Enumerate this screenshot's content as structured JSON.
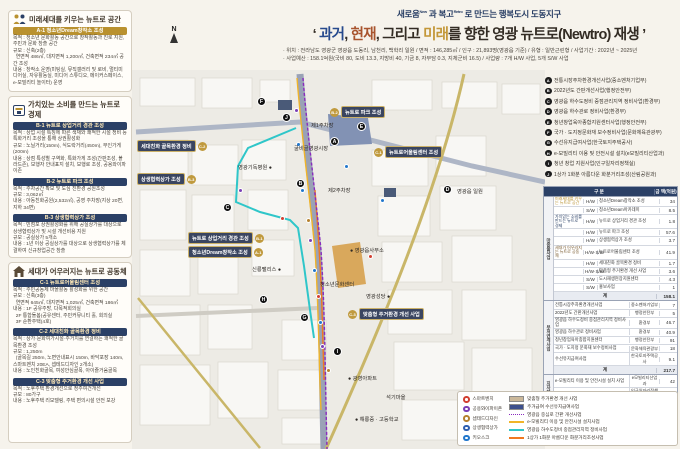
{
  "header": {
    "sub_s1": "새로움",
    "sub_sup1": "New",
    "sub_s2": " 과 복고",
    "sub_sup2": "Retro",
    "sub_s3": " 로 만드는 행복도시 도동지구",
    "title_q1": "‘ ",
    "title_past": "과거",
    "title_t1": ", ",
    "title_now": "현재",
    "title_t2": ", 그리고 ",
    "title_future": "미래",
    "title_rest": "를 향한 영광 뉴트로(Newtro) 재생",
    "title_q2": " ’",
    "info_line1": "· 위치 : 전라남도 영광군 영광읍 도동리, 남천리, 백학리 일원 / 면적 : 146,285㎡ / 인구 : 21,893명(영광읍 기준) / 유형 : 일반근린형 / 사업기간 : 2022년 ~ 2025년",
    "info_line2": "· 사업예산 : 158.1억원(국비 80, 도비 13.3, 지방비 40, 기금 8, 자부담 0.3, 지체군비 16.5) / 사업량 : 7개 H/W 사업, 5개 S/W 사업"
  },
  "sidebar": {
    "sections": [
      {
        "title": "미래세대를 키우는 뉴트로 공간",
        "projects": [
          {
            "bar": "A-1 청소년Dream창작소 조성",
            "lines": [
              "목적 : 청소년 문화활동 공간으로 창작활동과 진로 지원, 주민과 문화 창출 공간",
              "규모 : 신축(2층)",
              "  연면적 486㎡, 대지면적 1,200㎡, 건축면적 234㎡ 공간 조성",
              "내용 : 창작소 운영(미팅실, 뮤직갤러리 및 로비, 멀티미디어실, 자유활동실, 미디어 스튜디오, 메이커스페이스, e-모빌리티 놀이터) 운영"
            ]
          }
        ]
      },
      {
        "title": "가치있는 소비를 만드는 뉴트로 경제",
        "projects": [
          {
            "bar": "B-1 뉴트로 상업거리 경관 조성",
            "lines": [
              "목적 : 상업 시설 특징에 따른 색채와 쾌적한 시설 정비 등 특화거리 조성을 통해 상권활성화",
              "규모 : 노닐거리(150m), 식도락거리(450m), 무인가게(200m)",
              "내용 : 상점 특성별 구역화, 특화가게 조성(간판조성, 볼라드존), 보행자 안내표지 설치, 보행로 조성, 공용와이파이존"
            ]
          },
          {
            "bar": "B-2 뉴트로 파크 조성",
            "lines": [
              "목적 : 주차공간 확보 및 도심 친환경 공원조성",
              "규모 : 3,062㎡",
              "내용 : 아동친화공원(2,532㎡), 공영 주차장(지상 20면, 지하 34면)"
            ]
          },
          {
            "bar": "B-3 상생협력상가 조성",
            "lines": [
              "목적 : 빈점포 상권활성화를 위해 공실상가를 대상으로 상생협력상가 및 시설 개선비용 지원",
              "규모 : 공실상가 5개소",
              "내용 : 1년 이상 공실상가를 대상으로 상생협력상가를 체결하여 신규창업공간 창출"
            ]
          }
        ]
      },
      {
        "title": "세대가 어우러지는 뉴트로 공동체",
        "projects": [
          {
            "bar": "C-1 뉴트로어울림센터 조성",
            "lines": [
              "목적 : 주민공동체 마을활동 활성화를 위한 공간",
              "규모 : 신축(3층)",
              "  연면적 645㎡, 대지면적 1,025㎡, 건축면적 186㎡",
              "내용 : 1F 공유주방, 다목적회의실",
              "  2F 통합돌봄(공유센터, 주민커뮤니티 홀, 회의실",
              "  3F 순환주택(4호)"
            ]
          },
          {
            "bar": "C-2 세대친화 골목환경 정비",
            "lines": [
              "목적 : 상가·문화여가시설·주거지를 연결하는 쾌적한 골목환경 조성",
              "규모 : 1,250m",
              "  (골목길 250m, 노면안내표시 150m, 바닥포장 140m, 스마트벤치 20EA, 셉테드디자인 2개소)",
              "내용 : 노인친화골목, 여성안심골목, 아이즐거움골목"
            ]
          },
          {
            "bar": "C-3 맞춤형 주거환경 개선 사업",
            "lines": [
              "목적 : 노후주택 환경개선으로 정주여건개선",
              "규모 : 80가구",
              "내용 : 노후주택 리모델링, 주택 편의시설 안전 보강"
            ]
          }
        ]
      }
    ]
  },
  "linked_projects": [
    {
      "letter": "A",
      "label": "전통시장주차환경개선사업(중소벤처기업부)"
    },
    {
      "letter": "B",
      "label": "2022년도 간판개선사업(행정안전부)"
    },
    {
      "letter": "C",
      "label": "영광읍 하수도정비 중점관리지역 정비사업(환경부)"
    },
    {
      "letter": "D",
      "label": "영광읍 하수관로 정비사업(환경부)"
    },
    {
      "letter": "E",
      "label": "청년창업육아종합지원센터사업(행정안전부)"
    },
    {
      "letter": "F",
      "label": "국가 · 도지정문화재 보수정비사업(문화체육관광부)"
    },
    {
      "letter": "G",
      "label": "수선유지급여사업(한국토지주택공사)"
    },
    {
      "letter": "H",
      "label": "e-모빌리티 이용 및 안전시설 설치(e모빌리티산업과)"
    },
    {
      "letter": "I",
      "label": "청년 창업 지원사업(인구일자리정책실)"
    },
    {
      "letter": "J",
      "label": "1상가 1화분 아름다운 화분거리조성(산림공원과)"
    }
  ],
  "budget_table": {
    "header_col1": "구 분",
    "header_col2": "금 액(억원)",
    "subtotal_label": "계",
    "total_label": "총 액",
    "total": "420",
    "groups": [
      {
        "name": "마중물사업",
        "subtotal": "158.1",
        "rows": [
          {
            "cat": "미래세대를 키우는 뉴트로 공간",
            "cat_color": "#b9912f",
            "type": "H/W",
            "item": "청소년Dream창작소 조성",
            "amt": "34"
          },
          {
            "type": "S/W",
            "item": "청소년Dream아카데미",
            "amt": "8.5"
          },
          {
            "cat": "가치있는 소비를 만드는 뉴트로 경제",
            "cat_color": "#2b4066",
            "type": "H/W",
            "item": "뉴트로 상업거리 경관 조성",
            "amt": "1.8"
          },
          {
            "type": "H/W",
            "item": "뉴트로 파크 조성",
            "amt": "57.6"
          },
          {
            "type": "H/W",
            "item": "상생협력상가 조성",
            "amt": "3.7"
          },
          {
            "cat": "세대가 어우러지는 뉴트로 공동체",
            "cat_color": "#7a5a2e",
            "type": "H/W·S/W",
            "item": "뉴트로어울림센터 조성",
            "amt": "41.9"
          },
          {
            "type": "H/W",
            "item": "세대친화 골목환경 정비",
            "amt": "1.7"
          },
          {
            "type": "H/W·S/W",
            "item": "맞춤형 주거환경 개선 사업",
            "amt": "3.6"
          },
          {
            "type": "S/W",
            "item": "도시재생현장지원센터",
            "amt": "4.3"
          },
          {
            "type": "S/W",
            "item": "홍보사업",
            "amt": "1"
          }
        ]
      },
      {
        "name": "부처연계사업",
        "subtotal": "217.7",
        "rows": [
          {
            "item": "전통시장주차환경개선사업",
            "dept": "중소벤처기업부",
            "amt": "7"
          },
          {
            "item": "2022년도 간판개선사업",
            "dept": "행정안전부",
            "amt": "5"
          },
          {
            "item": "영광읍 하수도정비 중점관리지역 정비사업",
            "dept": "환경부",
            "amt": "46.7"
          },
          {
            "item": "영광읍 하수관로 정비사업",
            "dept": "환경부",
            "amt": "40.9"
          },
          {
            "item": "청년창업육아종합지원센터",
            "dept": "행정안전부",
            "amt": "91"
          },
          {
            "item": "국가 · 도지정 문화재 보수정비사업",
            "dept": "문화체육관광부",
            "amt": "18"
          },
          {
            "item": "수선유지급여사업",
            "dept": "한국토지주택공사",
            "amt": "9.1"
          }
        ]
      },
      {
        "name": "지자체연계사업",
        "subtotal": "44.2",
        "rows": [
          {
            "item": "e-모빌리티 이용 및 안전시설 설치 사업",
            "dept": "e모빌리티산업과",
            "amt": "42"
          },
          {
            "item": "청년 창업 지원사업",
            "dept": "인구일자리정책실",
            "amt": "1.2"
          },
          {
            "item": "1상가 1화분 아름다운 화분거리조성",
            "dept": "산림공원과",
            "amt": "1"
          }
        ]
      }
    ]
  },
  "legend": {
    "point_items": [
      {
        "name": "스마트벤치",
        "color": "#d23f31"
      },
      {
        "name": "공용와이파이존",
        "color": "#7b3fb5"
      },
      {
        "name": "셉테드디자인",
        "color": "#b5812f"
      },
      {
        "name": "상생협력상가",
        "color": "#2e5fb0"
      },
      {
        "name": "키오스크",
        "color": "#2277cc"
      }
    ],
    "line_items": [
      {
        "name": "맞춤형 주거환경 개선 사업",
        "swatch": "patch",
        "color": "#cbb89a"
      },
      {
        "name": "주거급여 수선유지급여사업",
        "swatch": "patch",
        "color": "#3d4f8c"
      },
      {
        "name": "영광읍 중심로 간판 개선사업",
        "swatch": "dotted",
        "color": "#8a2bbf"
      },
      {
        "name": "e-모빌리티 이용 및 안전시설 설치사업",
        "swatch": "line",
        "color": "#f0b429"
      },
      {
        "name": "영광읍 하수도정비 중점관리지역 정비사업",
        "swatch": "line",
        "color": "#2fc6c9"
      },
      {
        "name": "1상가 1화분 아름다운 화분거리조성사업",
        "swatch": "line",
        "color": "#f07820"
      }
    ]
  },
  "map": {
    "compass": "N",
    "callouts": [
      {
        "x": 5,
        "y": 70,
        "badge": "C-2",
        "label": "세대친화 골목환경 정비",
        "side": "right"
      },
      {
        "x": 5,
        "y": 103,
        "badge": "B-3",
        "label": "상생협력상가 조성",
        "side": "right"
      },
      {
        "x": 198,
        "y": 36,
        "badge": "B-2",
        "label": "뉴트로 파크 조성",
        "side": "left"
      },
      {
        "x": 242,
        "y": 76,
        "badge": "C-1",
        "label": "뉴트로어울림센터 조성",
        "side": "left"
      },
      {
        "x": 56,
        "y": 162,
        "badge": "B-1",
        "label": "뉴트로 상업거리 경관 조성",
        "side": "right"
      },
      {
        "x": 56,
        "y": 176,
        "badge": "A-1",
        "label": "청소년Dream창작소 조성",
        "side": "right"
      },
      {
        "x": 216,
        "y": 238,
        "badge": "C-3",
        "label": "맞춤형 주거환경 개선 사업",
        "side": "left"
      }
    ],
    "markers": [
      {
        "x": 130,
        "y": 32,
        "letter": "F"
      },
      {
        "x": 155,
        "y": 48,
        "letter": "J"
      },
      {
        "x": 230,
        "y": 57,
        "letter": "E"
      },
      {
        "x": 203,
        "y": 72,
        "letter": "A"
      },
      {
        "x": 169,
        "y": 114,
        "letter": "B"
      },
      {
        "x": 316,
        "y": 120,
        "letter": "D"
      },
      {
        "x": 96,
        "y": 138,
        "letter": "C"
      },
      {
        "x": 132,
        "y": 230,
        "letter": "H"
      },
      {
        "x": 173,
        "y": 248,
        "letter": "G"
      },
      {
        "x": 206,
        "y": 282,
        "letter": "I"
      }
    ],
    "labels": [
      {
        "x": 181,
        "y": 54,
        "text": "제1주차장"
      },
      {
        "x": 164,
        "y": 77,
        "text": "굴비골영광시장"
      },
      {
        "x": 198,
        "y": 119,
        "text": "제2주차장"
      },
      {
        "x": 327,
        "y": 120,
        "text": "영광읍 일원"
      },
      {
        "x": 108,
        "y": 96,
        "text": "영광기독병원 ●"
      },
      {
        "x": 220,
        "y": 179,
        "text": "● 영광읍사무소"
      },
      {
        "x": 122,
        "y": 198,
        "text": "신룡팰리스 ●"
      },
      {
        "x": 190,
        "y": 213,
        "text": "청소년문화센터"
      },
      {
        "x": 236,
        "y": 225,
        "text": "영광성당 ●"
      },
      {
        "x": 218,
        "y": 307,
        "text": "● 광영아파트"
      },
      {
        "x": 256,
        "y": 326,
        "text": "석기마을"
      },
      {
        "x": 225,
        "y": 348,
        "text": "● 해룡중 · 고등학교"
      }
    ],
    "pois": [
      {
        "x": 164,
        "y": 40,
        "color": "#7b3fb5"
      },
      {
        "x": 166,
        "y": 74,
        "color": "#2277cc"
      },
      {
        "x": 108,
        "y": 120,
        "color": "#7b3fb5"
      },
      {
        "x": 150,
        "y": 148,
        "color": "#d23f31"
      },
      {
        "x": 170,
        "y": 120,
        "color": "#2277cc"
      },
      {
        "x": 176,
        "y": 150,
        "color": "#b5812f"
      },
      {
        "x": 178,
        "y": 170,
        "color": "#7b3fb5"
      },
      {
        "x": 182,
        "y": 200,
        "color": "#2277cc"
      },
      {
        "x": 186,
        "y": 226,
        "color": "#d23f31"
      },
      {
        "x": 188,
        "y": 252,
        "color": "#2277cc"
      },
      {
        "x": 190,
        "y": 276,
        "color": "#7b3fb5"
      },
      {
        "x": 196,
        "y": 300,
        "color": "#b5812f"
      },
      {
        "x": 214,
        "y": 96,
        "color": "#2277cc"
      },
      {
        "x": 250,
        "y": 130,
        "color": "#2277cc"
      },
      {
        "x": 238,
        "y": 186,
        "color": "#d23f31"
      }
    ]
  }
}
